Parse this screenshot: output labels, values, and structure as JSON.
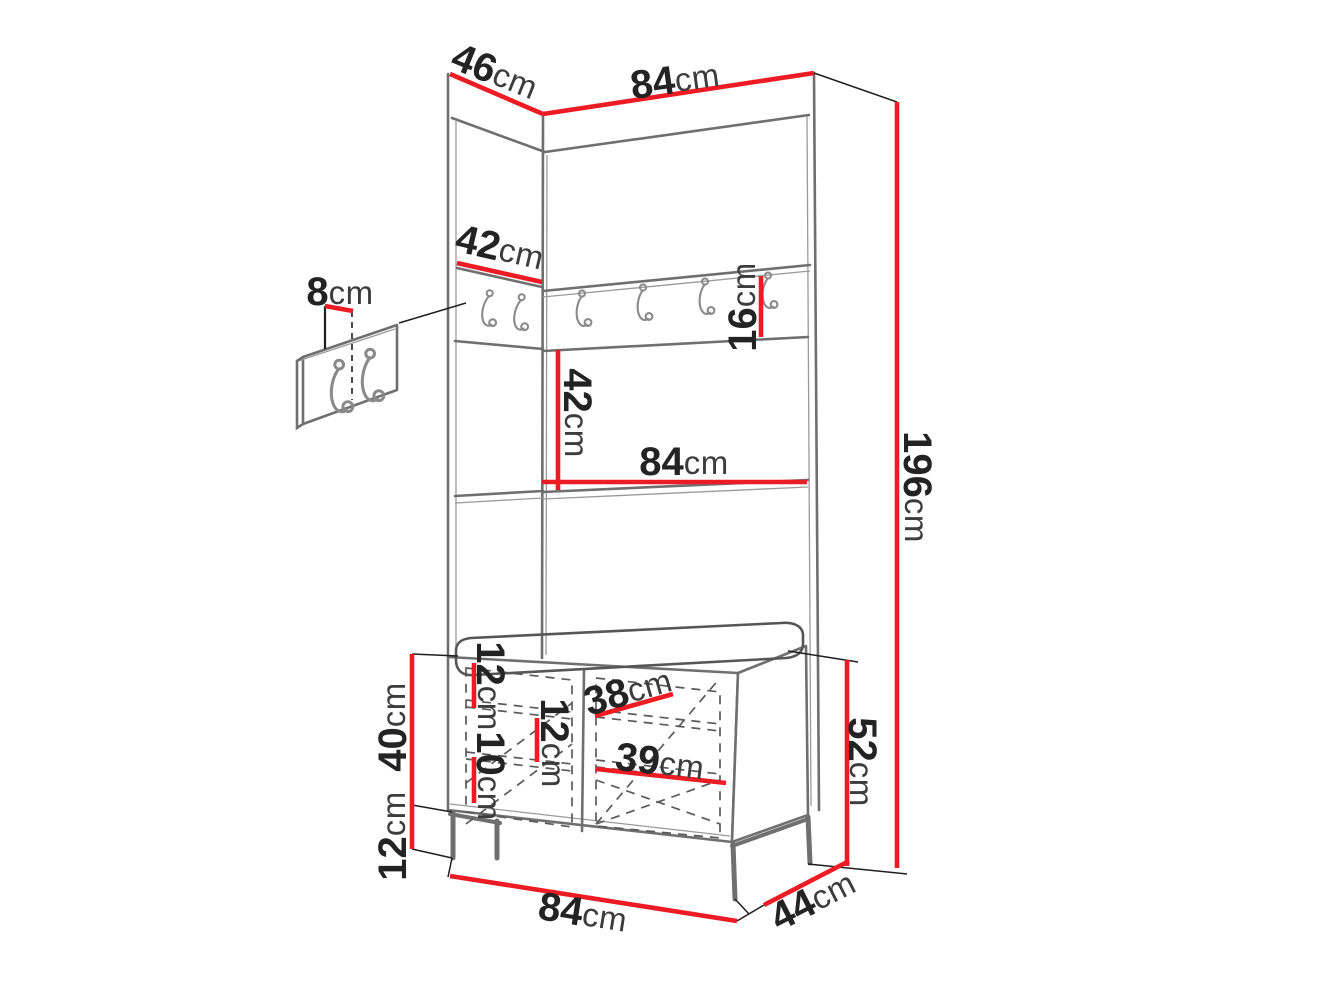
{
  "diagram": {
    "kind": "furniture-dimension-drawing",
    "subject": "hallway wardrobe set with hook panel and shoe bench",
    "background_color": "#ffffff",
    "accent_color": "#ed1c24",
    "line_color": "#6f6f6f",
    "text_color": "#232323"
  },
  "dims": {
    "depth_top": {
      "value": "46",
      "unit": "cm"
    },
    "width_top": {
      "value": "84",
      "unit": "cm"
    },
    "side_width": {
      "value": "42",
      "unit": "cm"
    },
    "detail_offset": {
      "value": "8",
      "unit": "cm"
    },
    "rail_height": {
      "value": "16",
      "unit": "cm"
    },
    "middle_height": {
      "value": "42",
      "unit": "cm"
    },
    "middle_width": {
      "value": "84",
      "unit": "cm"
    },
    "total_height": {
      "value": "196",
      "unit": "cm"
    },
    "bench_body": {
      "value": "40",
      "unit": "cm"
    },
    "legs_height": {
      "value": "12",
      "unit": "cm"
    },
    "door_top": {
      "value": "12",
      "unit": "cm"
    },
    "door_mid": {
      "value": "12",
      "unit": "cm"
    },
    "door_low": {
      "value": "10",
      "unit": "cm"
    },
    "inner_upper": {
      "value": "38",
      "unit": "cm"
    },
    "inner_lower": {
      "value": "39",
      "unit": "cm"
    },
    "bench_total": {
      "value": "52",
      "unit": "cm"
    },
    "bench_width": {
      "value": "84",
      "unit": "cm"
    },
    "bench_depth": {
      "value": "44",
      "unit": "cm"
    }
  }
}
